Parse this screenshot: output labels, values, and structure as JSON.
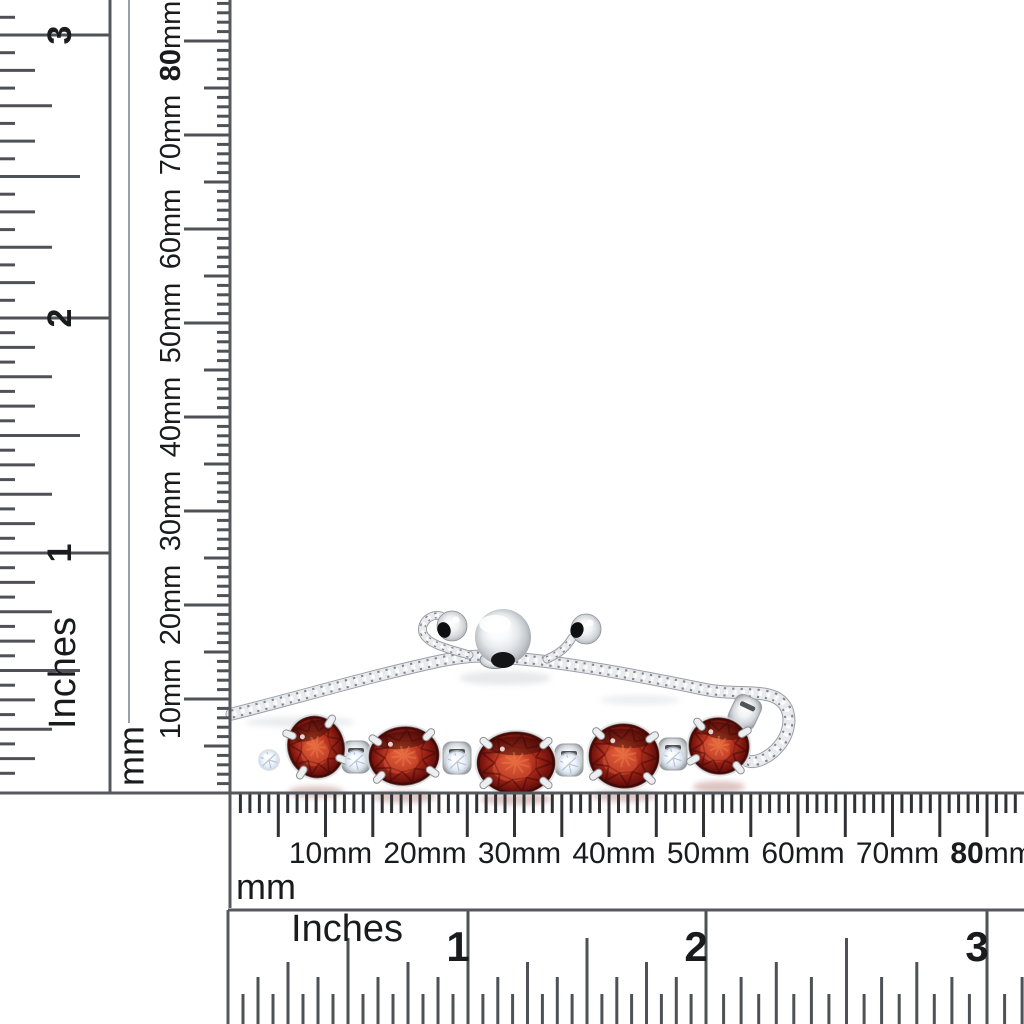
{
  "image": {
    "width": 1024,
    "height": 1024,
    "background": "#ffffff",
    "subject": "Sterling silver adjustable bolo bracelet with five oval red garnet stones and round white accent stones, photographed with inch and millimeter rulers for scale"
  },
  "palette": {
    "ruler_line": "#55585c",
    "ruler_line_light": "#9aa0a4",
    "ruler_tick": "#4e5256",
    "ruler_tick_dark": "#303235",
    "label": "#1a1b1d",
    "metal_light": "#f2f3f4",
    "metal_mid": "#c7cbd0",
    "metal_dark": "#868b91",
    "garnet_bright": "#e8703f",
    "garnet_mid": "#b93722",
    "garnet_dark": "#3c0605",
    "accent_light": "#ffffff",
    "accent_shade": "#b4c2d4",
    "hole": "#0d0e10"
  },
  "rulers": {
    "frame_lines": [
      {
        "x1": 0,
        "y1": 793,
        "x2": 1024,
        "y2": 793,
        "w": 3,
        "light": false
      },
      {
        "x1": 228,
        "y1": 910,
        "x2": 1024,
        "y2": 910,
        "w": 3,
        "light": false
      },
      {
        "x1": 110,
        "y1": 0,
        "x2": 110,
        "y2": 793,
        "w": 3,
        "light": false
      },
      {
        "x1": 230,
        "y1": 0,
        "x2": 230,
        "y2": 908,
        "w": 3,
        "light": false
      },
      {
        "x1": 129,
        "y1": 0,
        "x2": 129,
        "y2": 723,
        "w": 2,
        "light": true
      },
      {
        "x1": 228,
        "y1": 910,
        "x2": 228,
        "y2": 1024,
        "w": 3,
        "light": false
      }
    ],
    "left_inches": {
      "unit": "Inches",
      "unit_center": [
        63,
        673
      ],
      "unit_size": 38,
      "numbers": [
        {
          "label": "3",
          "pos": 35
        },
        {
          "label": "2",
          "pos": 318
        },
        {
          "label": "1",
          "pos": 553
        }
      ],
      "span_before": 283,
      "span_after": 235,
      "range": [
        0,
        789
      ],
      "tick_lengths": {
        "s16": 15,
        "s8": 35,
        "s4": 52,
        "s2": 80
      },
      "edge": 110,
      "number_x": 60,
      "number_size": 34
    },
    "left_mm": {
      "unit": "mm",
      "unit_center": [
        131,
        756
      ],
      "unit_size": 36,
      "origin": 793,
      "px_per_mm": 9.4,
      "mm_max": 84,
      "edge": 230,
      "tick_lengths": {
        "m1": 13,
        "m5": 26,
        "m10": 46
      },
      "labels": [
        {
          "text": "10",
          "suffix": "mm",
          "mm": 10,
          "bold": false
        },
        {
          "text": "20",
          "suffix": "mm",
          "mm": 20,
          "bold": false
        },
        {
          "text": "30",
          "suffix": "mm",
          "mm": 30,
          "bold": false
        },
        {
          "text": "40",
          "suffix": "mm",
          "mm": 40,
          "bold": false
        },
        {
          "text": "50",
          "suffix": "mm",
          "mm": 50,
          "bold": false
        },
        {
          "text": "60",
          "suffix": "mm",
          "mm": 60,
          "bold": false
        },
        {
          "text": "70",
          "suffix": "mm",
          "mm": 70,
          "bold": false
        },
        {
          "text": "80",
          "suffix": "mm",
          "mm": 80,
          "bold": true
        }
      ],
      "label_x": 171,
      "label_offset": 0,
      "label_size": 29
    },
    "bottom_mm": {
      "unit": "mm",
      "unit_pos": [
        236,
        899
      ],
      "unit_size": 36,
      "origin": 231,
      "px_per_mm": 9.45,
      "mm_max": 83,
      "edge": 793,
      "tick_lengths": {
        "m1": 20,
        "m5": 44,
        "m10": 44
      },
      "labels": [
        {
          "text": "10",
          "suffix": "mm",
          "mm": 10,
          "bold": false
        },
        {
          "text": "20",
          "suffix": "mm",
          "mm": 20,
          "bold": false
        },
        {
          "text": "30",
          "suffix": "mm",
          "mm": 30,
          "bold": false
        },
        {
          "text": "40",
          "suffix": "mm",
          "mm": 40,
          "bold": false
        },
        {
          "text": "50",
          "suffix": "mm",
          "mm": 50,
          "bold": false
        },
        {
          "text": "60",
          "suffix": "mm",
          "mm": 60,
          "bold": false
        },
        {
          "text": "70",
          "suffix": "mm",
          "mm": 70,
          "bold": false
        },
        {
          "text": "80",
          "suffix": "mm",
          "mm": 80,
          "bold": true
        }
      ],
      "label_offset": 5,
      "label_baseline": 863,
      "label_size": 30
    },
    "bottom_inches": {
      "unit": "Inches",
      "unit_center": [
        347,
        941
      ],
      "unit_size": 38,
      "numbers": [
        {
          "label": "",
          "pos": 228
        },
        {
          "label": "1",
          "pos": 468
        },
        {
          "label": "2",
          "pos": 706
        },
        {
          "label": "3",
          "pos": 987
        }
      ],
      "span_after": 281,
      "range": [
        228,
        1024
      ],
      "top": 910,
      "bottom": 1024,
      "tick_lengths": {
        "s16": 30,
        "s8": 47,
        "s4": 62,
        "s2": 86
      },
      "number_dx": -10,
      "number_y": 961,
      "number_size": 42
    }
  },
  "bracelet": {
    "chain_paths": [
      {
        "d": "M232,714 C300,697 370,676 440,661 C465,656 485,655 500,657",
        "w": 11
      },
      {
        "d": "M508,658 C560,661 640,676 703,689 C736,696 766,688 781,701 C794,713 791,737 772,753 C763,760 754,763 748,761",
        "w": 11
      },
      {
        "d": "M469,655 C450,649 428,645 423,633 C420,622 431,613 441,616",
        "w": 7
      },
      {
        "d": "M547,659 C560,653 566,648 572,638",
        "w": 7
      }
    ],
    "links": [
      {
        "cx": 744,
        "cy": 714,
        "rot": 25
      }
    ],
    "garnets": [
      {
        "cx": 316,
        "cy": 747,
        "rx": 28,
        "ry": 31,
        "rot": -18
      },
      {
        "cx": 404,
        "cy": 756,
        "rx": 35,
        "ry": 29,
        "rot": -6
      },
      {
        "cx": 516,
        "cy": 763,
        "rx": 39,
        "ry": 31,
        "rot": 0
      },
      {
        "cx": 624,
        "cy": 756,
        "rx": 35,
        "ry": 32,
        "rot": 4
      },
      {
        "cx": 719,
        "cy": 746,
        "rx": 30,
        "ry": 28,
        "rot": 10
      }
    ],
    "accents": [
      {
        "cx": 269,
        "cy": 760,
        "r": 9.5,
        "block": false
      },
      {
        "cx": 356,
        "cy": 761,
        "r": 10,
        "block": true
      },
      {
        "cx": 457,
        "cy": 762,
        "r": 10.5,
        "block": true
      },
      {
        "cx": 569,
        "cy": 764,
        "r": 10.5,
        "block": true
      },
      {
        "cx": 673,
        "cy": 758,
        "r": 10,
        "block": true
      }
    ],
    "slider": {
      "ball": {
        "cx": 503,
        "cy": 637,
        "r": 28
      },
      "notch": {
        "cx": 503,
        "cy": 660,
        "rx": 12,
        "ry": 8
      },
      "rondelle": {
        "cx": 495,
        "cy": 660,
        "rx": 15,
        "ry": 8.5
      },
      "dangles": [
        {
          "cx": 452,
          "cy": 626,
          "r": 15,
          "hole": {
            "cx": 444,
            "cy": 630,
            "rx": 6.5,
            "ry": 8,
            "rot": -20
          }
        },
        {
          "cx": 586,
          "cy": 629,
          "r": 15,
          "hole": {
            "cx": 577,
            "cy": 630,
            "rx": 6.5,
            "ry": 8,
            "rot": 15
          }
        }
      ]
    },
    "reflections": [
      {
        "cx": 300,
        "cy": 722,
        "rx": 55,
        "ry": 5,
        "fill": "#b9bec3",
        "o": 0.3
      },
      {
        "cx": 505,
        "cy": 678,
        "rx": 46,
        "ry": 7,
        "fill": "#aab0b6",
        "o": 0.28
      },
      {
        "cx": 640,
        "cy": 700,
        "rx": 40,
        "ry": 5,
        "fill": "#b9bec3",
        "o": 0.25
      },
      {
        "cx": 316,
        "cy": 792,
        "rx": 28,
        "ry": 6,
        "fill": "#8a3a30",
        "o": 0.3
      },
      {
        "cx": 404,
        "cy": 797,
        "rx": 32,
        "ry": 6,
        "fill": "#8a3a30",
        "o": 0.3
      },
      {
        "cx": 516,
        "cy": 799,
        "rx": 36,
        "ry": 6,
        "fill": "#8a3a30",
        "o": 0.3
      },
      {
        "cx": 624,
        "cy": 796,
        "rx": 32,
        "ry": 6,
        "fill": "#8a3a30",
        "o": 0.3
      },
      {
        "cx": 719,
        "cy": 787,
        "rx": 26,
        "ry": 6,
        "fill": "#8a3a30",
        "o": 0.3
      }
    ]
  }
}
